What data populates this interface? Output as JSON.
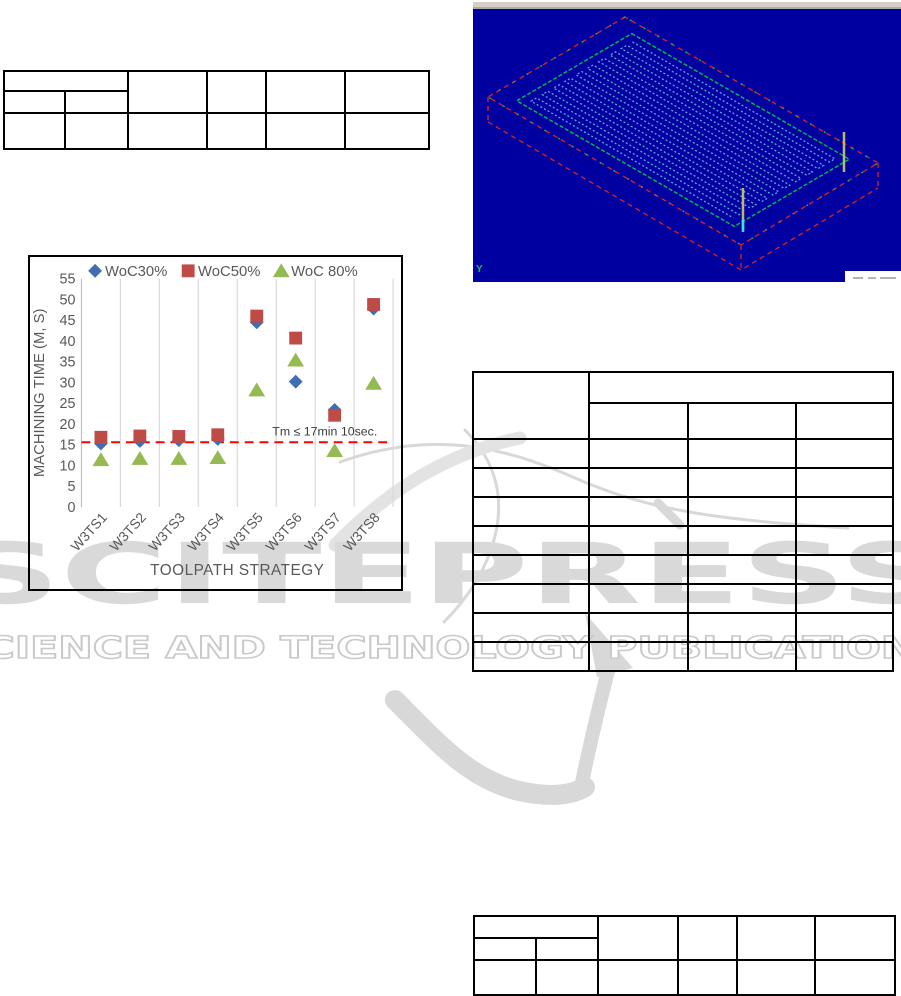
{
  "watermark": {
    "brand": "SCITEPRESS",
    "tagline": "SCIENCE AND TECHNOLOGY PUBLICATIONS",
    "letter_color": "#d9d9d9",
    "tagline_outline_color": "#c9c9c9",
    "swoosh_color": "#d8d8d8"
  },
  "cad_viewport": {
    "axis_label": "Y",
    "background": "#0000a0",
    "titlebar_color": "#d4d0c8",
    "stock_outline_color": "#dd2222",
    "boundary_color": "#00c04a",
    "toolpath_color": "#59a8e8",
    "tool_marker_color": "#b9b96a"
  },
  "chart_data": {
    "type": "scatter",
    "title": "",
    "xlabel": "TOOLPATH STRATEGY",
    "ylabel": "MACHINING TIME (M, S)",
    "categories": [
      "W3TS1",
      "W3TS2",
      "W3TS3",
      "W3TS4",
      "W3TS5",
      "W3TS6",
      "W3TS7",
      "W3TS8"
    ],
    "ylim": [
      0,
      55
    ],
    "yticks": [
      0,
      5,
      10,
      15,
      20,
      25,
      30,
      35,
      40,
      45,
      50,
      55
    ],
    "grid": "vertical-only",
    "legend_position": "top-center",
    "tick_color": "#595959",
    "grid_color": "#d9d9d9",
    "series": [
      {
        "name": "WoC30%",
        "marker": "diamond",
        "color": "#3e6fb4",
        "values": [
          15.3,
          15.9,
          16.1,
          16.4,
          44.5,
          30.2,
          23.4,
          47.8
        ]
      },
      {
        "name": "WoC50%",
        "marker": "square",
        "color": "#bf4b47",
        "values": [
          16.8,
          17.1,
          17.0,
          17.4,
          46.0,
          40.7,
          22.1,
          48.8
        ]
      },
      {
        "name": "WoC 80%",
        "marker": "triangle",
        "color": "#95ba52",
        "values": [
          11.4,
          11.7,
          11.7,
          11.9,
          28.2,
          35.4,
          13.6,
          29.8
        ]
      }
    ],
    "reference_line": {
      "value": 15.6,
      "label": "Tm ≤ 17min 10sec.",
      "color": "#ff0000",
      "style": "dashed"
    }
  },
  "tables": {
    "top_left": {
      "columns": 6,
      "header_rows": 2,
      "data_rows": 1,
      "cells_empty": true
    },
    "right": {
      "columns": 4,
      "header_rows": 2,
      "data_rows": 8,
      "cells_empty": true
    },
    "bottom_right": {
      "columns": 6,
      "header_rows": 2,
      "data_rows": 1,
      "cells_empty": true
    }
  }
}
